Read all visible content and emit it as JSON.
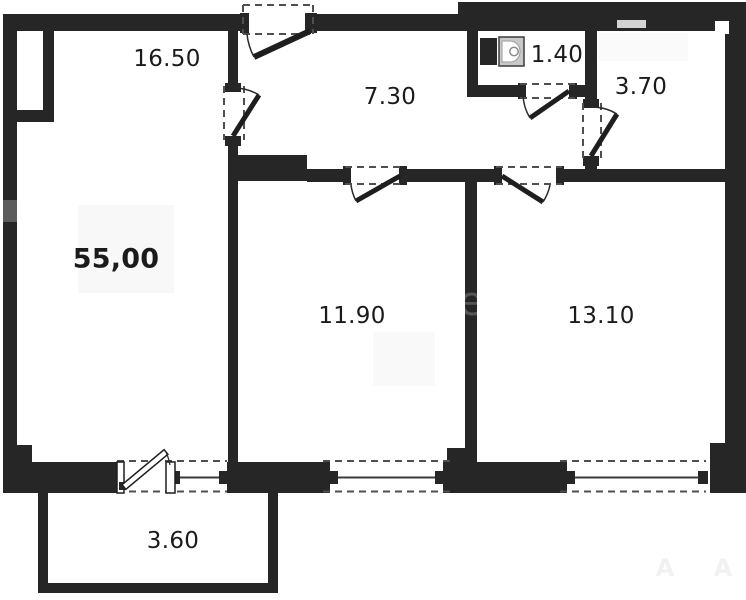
{
  "total_area": "55,00",
  "rooms": [
    {
      "name": "room-16-50",
      "area": "16.50"
    },
    {
      "name": "hallway",
      "area": "7.30"
    },
    {
      "name": "wc",
      "area": "1.40"
    },
    {
      "name": "room-3-70",
      "area": "3.70"
    },
    {
      "name": "room-11-90",
      "area": "11.90"
    },
    {
      "name": "room-13-10",
      "area": "13.10"
    },
    {
      "name": "balcony",
      "area": "3.60"
    }
  ],
  "watermark_letters": {
    "left": "А",
    "right": "А",
    "wall": "е"
  },
  "colors": {
    "wall": "#262626",
    "background": "#ffffff",
    "label": "#1b1b1b",
    "fixture_fill": "#c9c9c9",
    "watermark": "#f1f1f1"
  }
}
